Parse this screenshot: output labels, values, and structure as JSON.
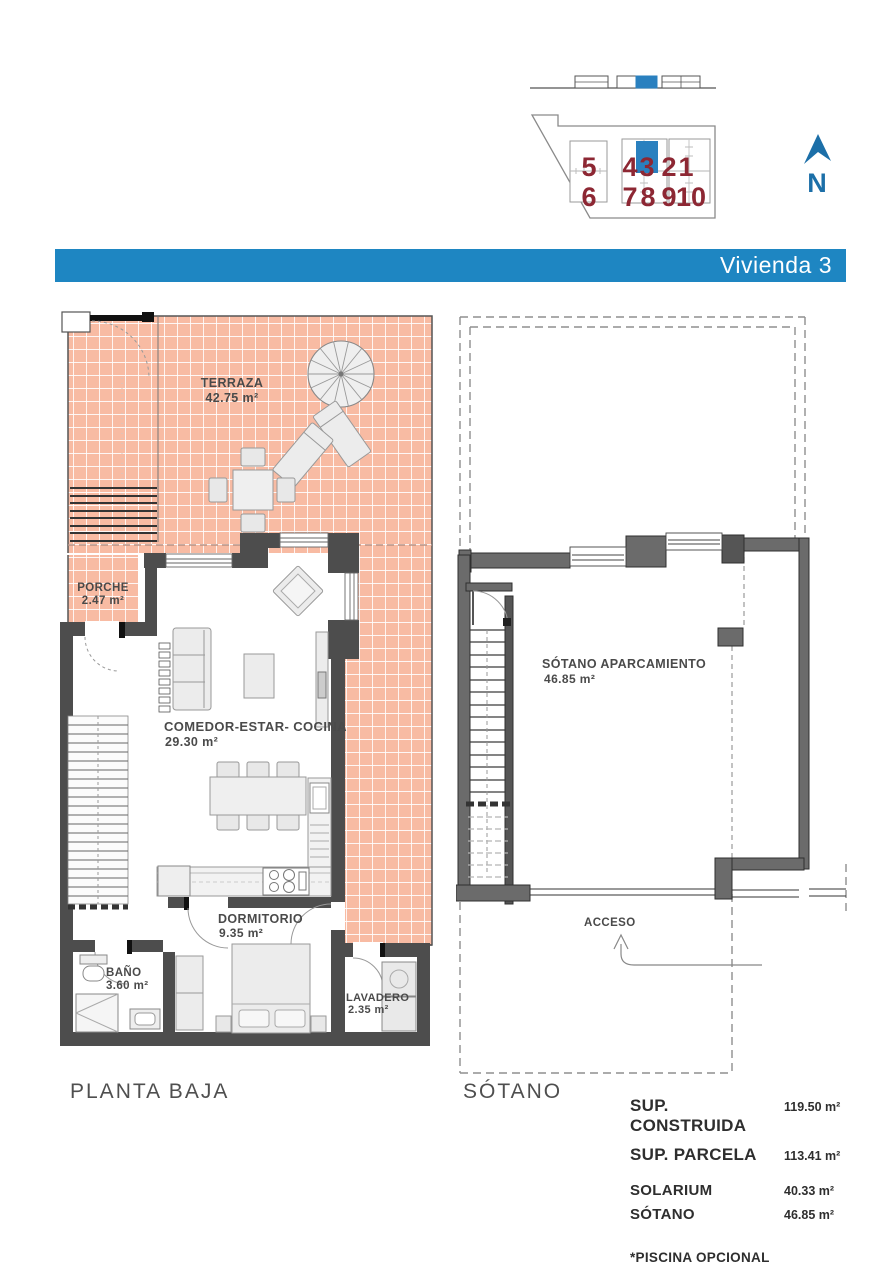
{
  "header": {
    "title": "Vivienda 3"
  },
  "site_plan": {
    "north_label": "N",
    "unit_numbers": [
      "5",
      "6",
      "4",
      "3",
      "7",
      "8",
      "2",
      "1",
      "9",
      "10"
    ],
    "highlighted_unit": "3"
  },
  "ground_floor": {
    "caption": "PLANTA BAJA",
    "terraza_label": "TERRAZA",
    "terraza_area": "42.75 m²",
    "porche_label": "PORCHE",
    "porche_area": "2.47 m²",
    "salon_label": "COMEDOR-ESTAR- COCINA",
    "salon_area": "29.30 m²",
    "dormitorio_label": "DORMITORIO",
    "dormitorio_area": "9.35 m²",
    "bano_label": "BAÑO",
    "bano_area": "3.60 m²",
    "lavadero_label": "LAVADERO",
    "lavadero_area": "2.35 m²"
  },
  "basement": {
    "caption": "SÓTANO",
    "aparcamiento_label": "SÓTANO APARCAMIENTO",
    "aparcamiento_area": "46.85 m²",
    "acceso_label": "ACCESO"
  },
  "summary": {
    "rows": [
      {
        "label": "SUP. CONSTRUIDA",
        "value": "119.50 m²"
      },
      {
        "label": "SUP. PARCELA",
        "value": "113.41 m²"
      },
      {
        "label": "SOLARIUM",
        "value": "40.33 m²"
      },
      {
        "label": "SÓTANO",
        "value": "46.85 m²"
      }
    ],
    "note": "*PISCINA OPCIONAL"
  },
  "colors": {
    "accent_blue": "#1e86c2",
    "unit_number_red": "#8d2733",
    "terrace_tile": "#f8bba3"
  }
}
